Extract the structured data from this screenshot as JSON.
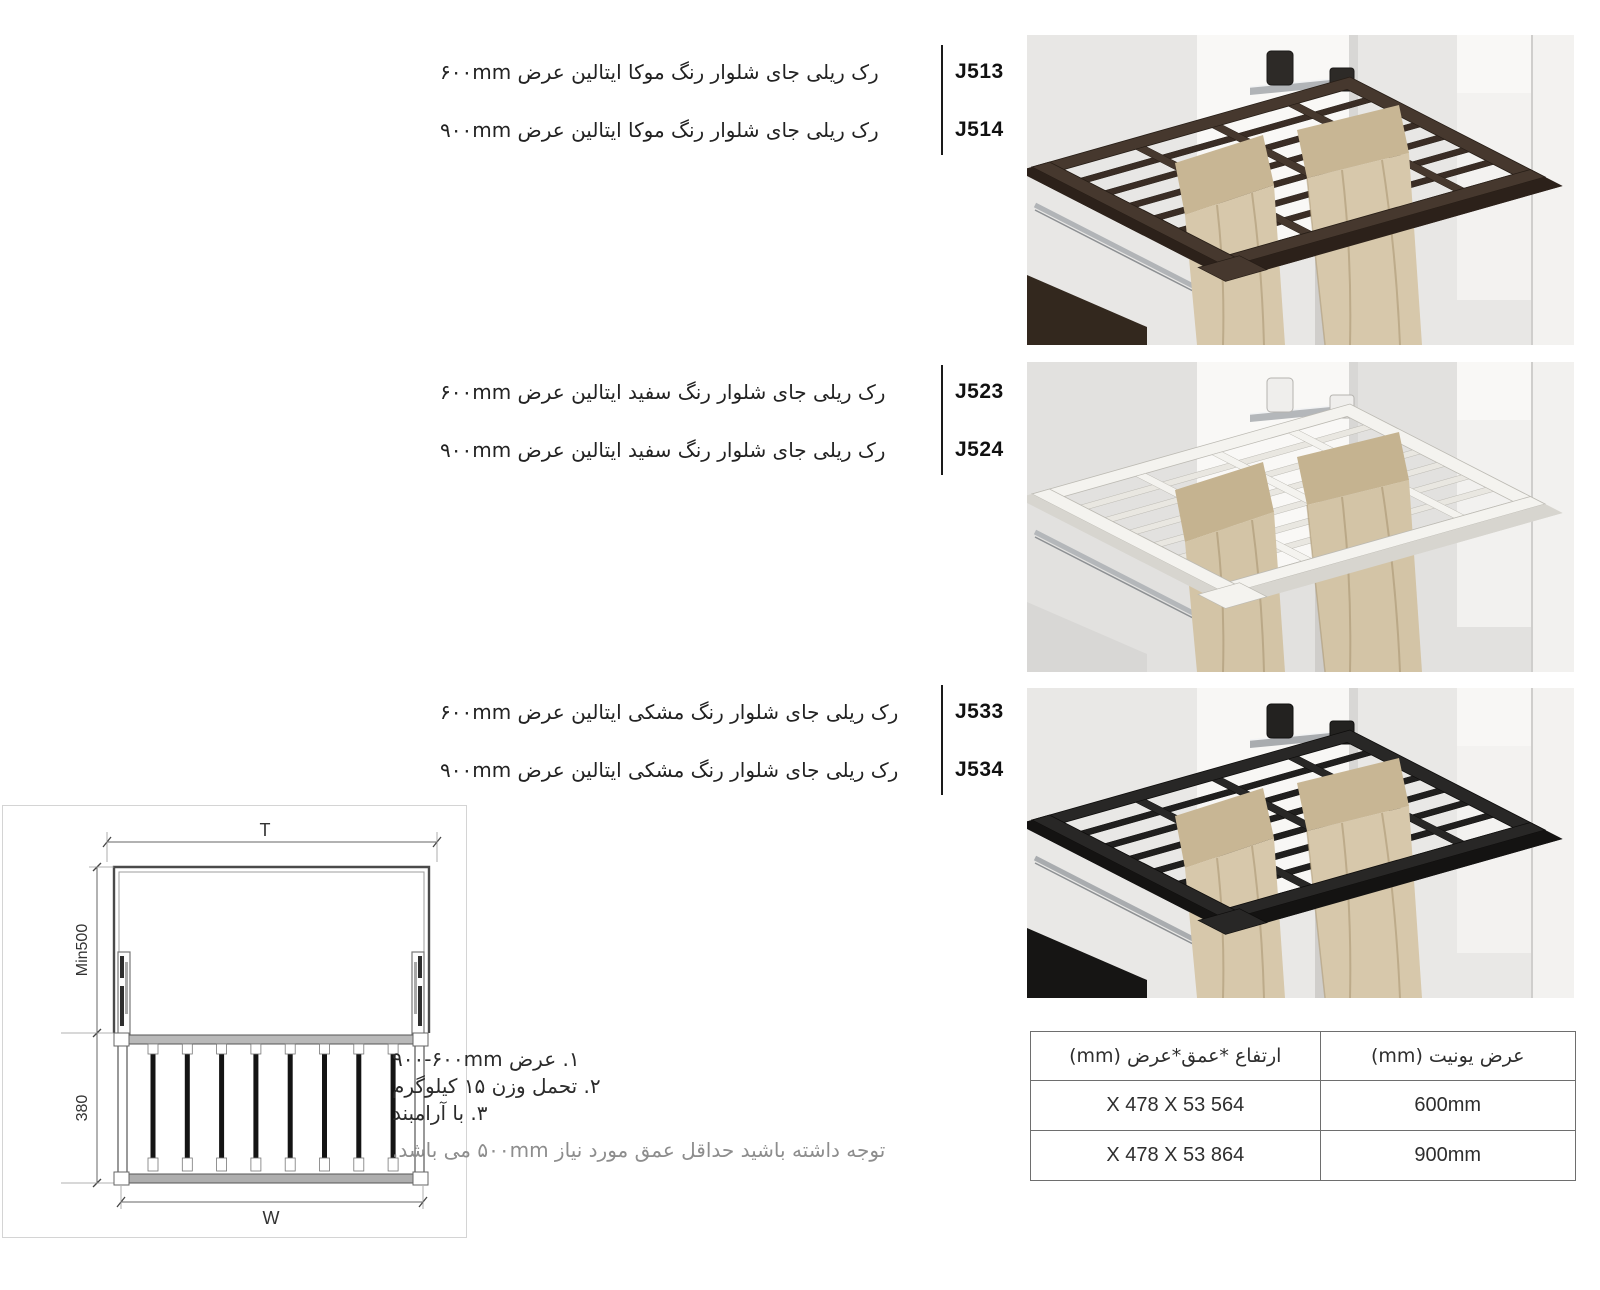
{
  "products": [
    {
      "items": [
        {
          "code": "J513",
          "desc": "رک ریلی جای شلوار رنگ موکا ایتالین عرض ۶۰۰mm"
        },
        {
          "code": "J514",
          "desc": "رک ریلی جای شلوار رنگ موکا ایتالین عرض ۹۰۰mm"
        }
      ]
    },
    {
      "items": [
        {
          "code": "J523",
          "desc": "رک ریلی جای شلوار رنگ سفید ایتالین عرض ۶۰۰mm"
        },
        {
          "code": "J524",
          "desc": "رک ریلی جای شلوار رنگ سفید ایتالین عرض ۹۰۰mm"
        }
      ]
    },
    {
      "items": [
        {
          "code": "J533",
          "desc": "رک ریلی جای شلوار رنگ مشکی ایتالین عرض ۶۰۰mm"
        },
        {
          "code": "J534",
          "desc": "رک ریلی جای شلوار رنگ مشکی ایتالین عرض ۹۰۰mm"
        }
      ]
    }
  ],
  "photos": [
    {
      "variant": "mocha",
      "wall": "#e8e7e5",
      "panel": "#f9f8f6",
      "pillar": "#f3f2f0",
      "rack": "#46382e",
      "rack_dark": "#2c211a",
      "rack_bar": "#3a2d25",
      "outline": "#261d16",
      "base": "#33281e",
      "pants": "#d7c8ab",
      "pants_mid": "#c8b694",
      "pants_shadow": "#a8946f",
      "chrome": "#b1b4b7",
      "bracket": "#2d2a27",
      "bracket_edge": "#1c1a18"
    },
    {
      "variant": "white",
      "wall": "#e2e1df",
      "panel": "#f9f8f6",
      "pillar": "#f2f1ef",
      "rack": "#f4f3ef",
      "rack_dark": "#d7d5cf",
      "rack_bar": "#e9e7e1",
      "outline": "#bcbab3",
      "base": "#d8d7d5",
      "pants": "#d3c4a6",
      "pants_mid": "#c5b390",
      "pants_shadow": "#a6926d",
      "chrome": "#b4b7ba",
      "bracket": "#efeeec",
      "bracket_edge": "#b5b3af"
    },
    {
      "variant": "black",
      "wall": "#e9e8e6",
      "panel": "#f8f7f5",
      "pillar": "#f3f2f0",
      "rack": "#282726",
      "rack_dark": "#141312",
      "rack_bar": "#201f1e",
      "outline": "#0e0d0c",
      "base": "#161514",
      "pants": "#d7c8ab",
      "pants_mid": "#c8b694",
      "pants_shadow": "#a8946f",
      "chrome": "#a9acaf",
      "bracket": "#232220",
      "bracket_edge": "#121110"
    }
  ],
  "diagram": {
    "labels": {
      "top": "T",
      "side_upper": "Min500",
      "side_lower": "380",
      "bottom": "W"
    }
  },
  "notes": {
    "items": [
      "۱. عرض ‪۹۰۰-۶۰۰mm‬",
      "۲. تحمل وزن ۱۵ کیلوگرم",
      "۳. با آرامبند"
    ],
    "warning": "توجه داشته باشید حداقل عمق مورد نیاز ۵۰۰mm می باشد."
  },
  "spec_table": {
    "headers": [
      "عرض یونیت (mm)",
      "ارتفاع *عمق*عرض (mm)"
    ],
    "rows": [
      [
        "600mm",
        "564 X 478 X 53"
      ],
      [
        "900mm",
        "864 X 478 X 53"
      ]
    ]
  }
}
